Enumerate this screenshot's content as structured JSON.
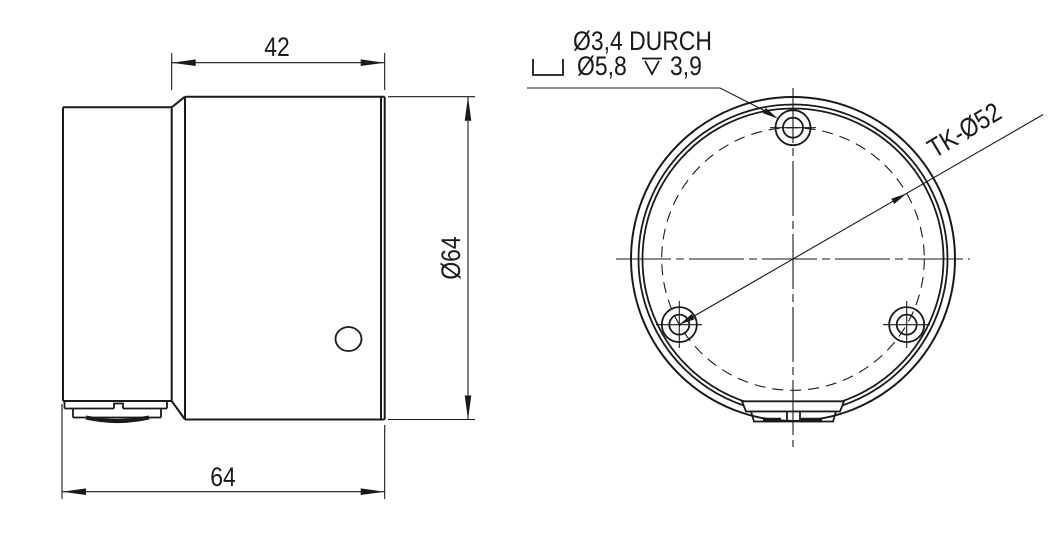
{
  "page": {
    "background": "#ffffff",
    "line_color": "#1a1a1a"
  },
  "side_view": {
    "width_dim": "42",
    "total_width_dim": "64",
    "diameter_dim": "Ø64"
  },
  "front_view": {
    "bolt_circle_dim": "TK-Ø52",
    "hole_note_line1": "Ø3,4 DURCH",
    "hole_note_counterbore": "Ø5,8",
    "hole_note_depth": "3,9",
    "hole_count": 3
  },
  "icons": {
    "counterbore-icon": "⌴",
    "depth-icon": "↧"
  }
}
